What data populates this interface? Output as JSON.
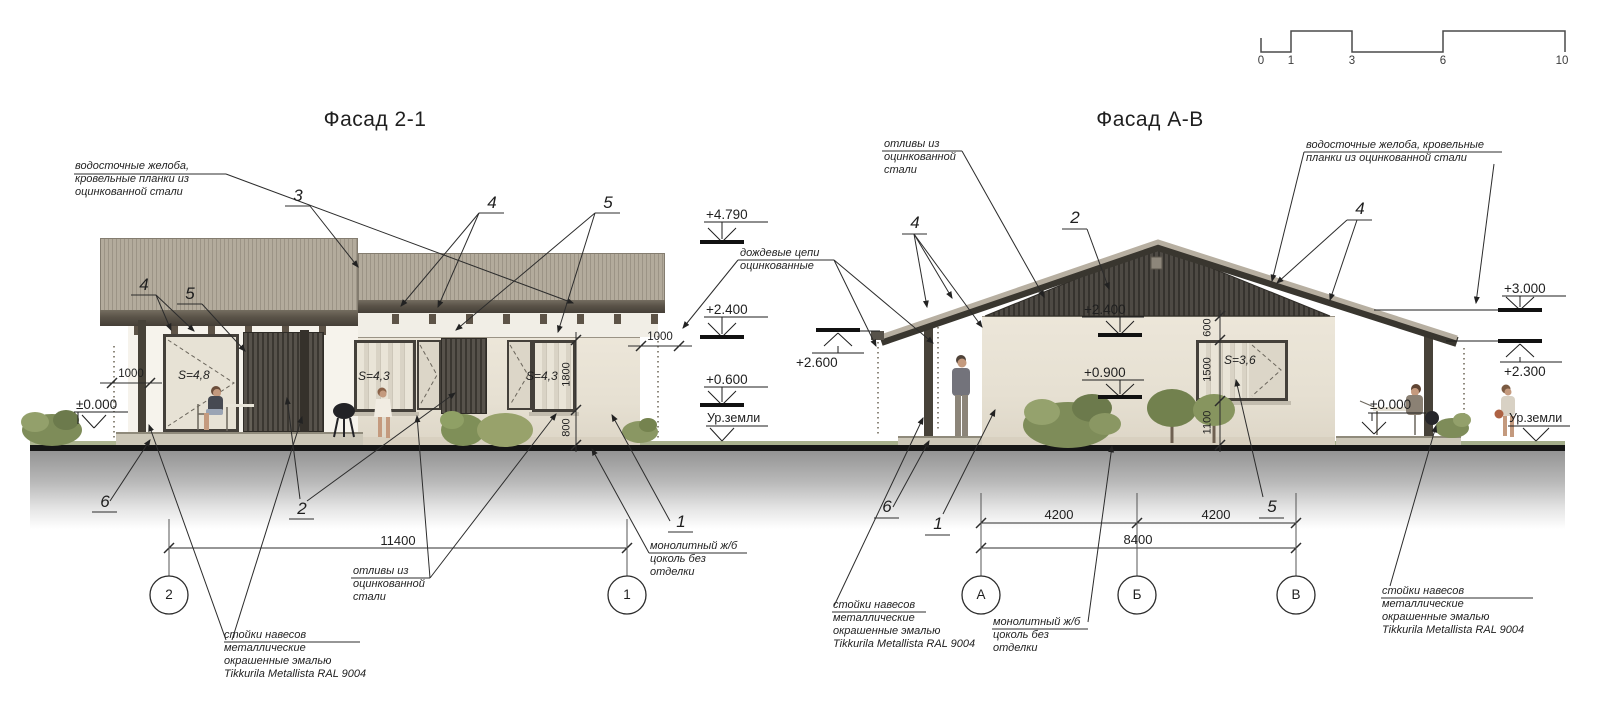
{
  "scale": {
    "t0": "0",
    "t1": "1",
    "t3": "3",
    "t6": "6",
    "t10": "10"
  },
  "facade21": {
    "title": "Фасад 2-1",
    "gutters1": "водосточные желоба,",
    "gutters2": "кровельные планки из",
    "gutters3": "оцинкованной стали",
    "otlivy1": "отливы из",
    "otlivy2": "оцинкованной",
    "otlivy3": "стали",
    "stoyki1": "стойки навесов",
    "stoyki2": "металлические",
    "stoyki3": "окрашенные эмалью",
    "stoyki4": "Tikkurila Metallista RAL 9004",
    "tsokol1": "монолитный ж/б",
    "tsokol2": "цоколь без",
    "tsokol3": "отделки",
    "m4790": "+4.790",
    "m2400": "+2.400",
    "m0600": "+0.600",
    "ground": "Ур.земли",
    "zero": "±0.000",
    "d1000l": "1000",
    "d1000r": "1000",
    "d1800": "1800",
    "d800": "800",
    "d11400": "11400",
    "s48": "S=4,8",
    "s43a": "S=4,3",
    "s43b": "S=4,3",
    "ax2": "2",
    "ax1": "1",
    "c3": "3",
    "c4t": "4",
    "c5t": "5",
    "c4l": "4",
    "c5l": "5",
    "c6": "6",
    "c2": "2",
    "c1": "1"
  },
  "facadeAB": {
    "title": "Фасад А-В",
    "otlivy1": "отливы из",
    "otlivy2": "оцинкованной",
    "otlivy3": "стали",
    "gutters1": "водосточные желоба, кровельные",
    "gutters2": "планки из оцинкованной стали",
    "chains1": "дождевые цепи",
    "chains2": "оцинкованные",
    "stoykiL1": "стойки навесов",
    "stoykiL2": "металлические",
    "stoykiL3": "окрашенные эмалью",
    "stoykiL4": "Tikkurila Metallista RAL 9004",
    "stoykiR1": "стойки навесов",
    "stoykiR2": "металлические",
    "stoykiR3": "окрашенные эмалью",
    "stoykiR4": "Tikkurila Metallista RAL 9004",
    "tsokol1": "монолитный ж/б",
    "tsokol2": "цоколь без",
    "tsokol3": "отделки",
    "m2600": "+2.600",
    "m3000": "+3.000",
    "m2300": "+2.300",
    "m2400": "+2.400",
    "m0900": "+0.900",
    "zero": "±0.000",
    "ground": "Ур.земли",
    "d4200a": "4200",
    "d4200b": "4200",
    "d8400": "8400",
    "d600": "600",
    "d1500": "1500",
    "d1100": "1100",
    "s36": "S=3,6",
    "axA": "А",
    "axB": "Б",
    "axV": "В",
    "c4a": "4",
    "c2": "2",
    "c4b": "4",
    "c6": "6",
    "c1": "1",
    "c5": "5"
  }
}
